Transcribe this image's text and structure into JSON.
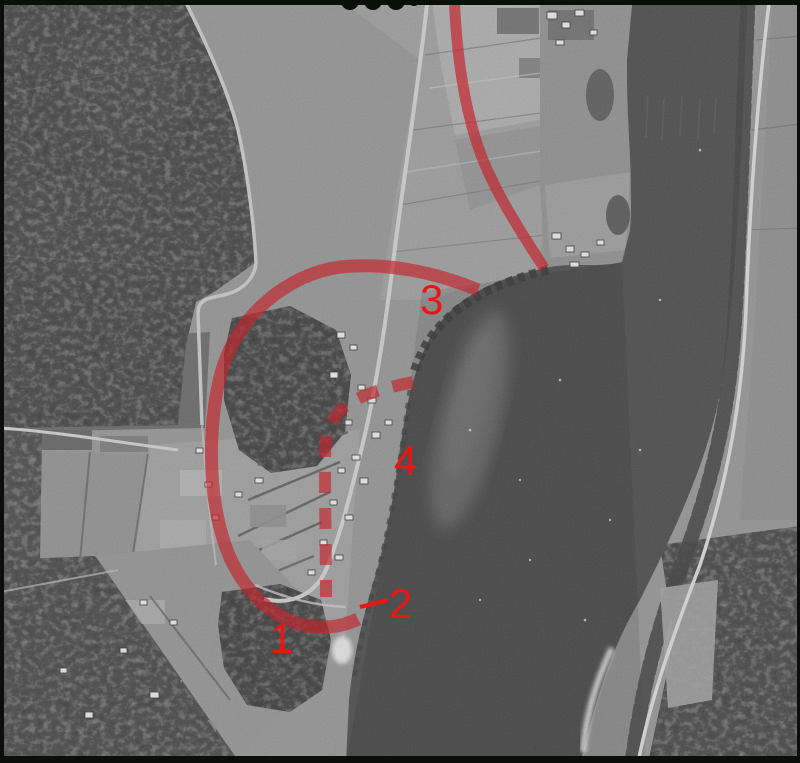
{
  "figure": {
    "kind": "annotated historical aerial photograph",
    "annotation_color": "#c4242c",
    "marker_color": "#ee1414"
  },
  "markers": [
    {
      "id": "marker-1",
      "label": "1"
    },
    {
      "id": "marker-2",
      "label": "2"
    },
    {
      "id": "marker-3",
      "label": "3"
    },
    {
      "id": "marker-4",
      "label": "4"
    }
  ]
}
